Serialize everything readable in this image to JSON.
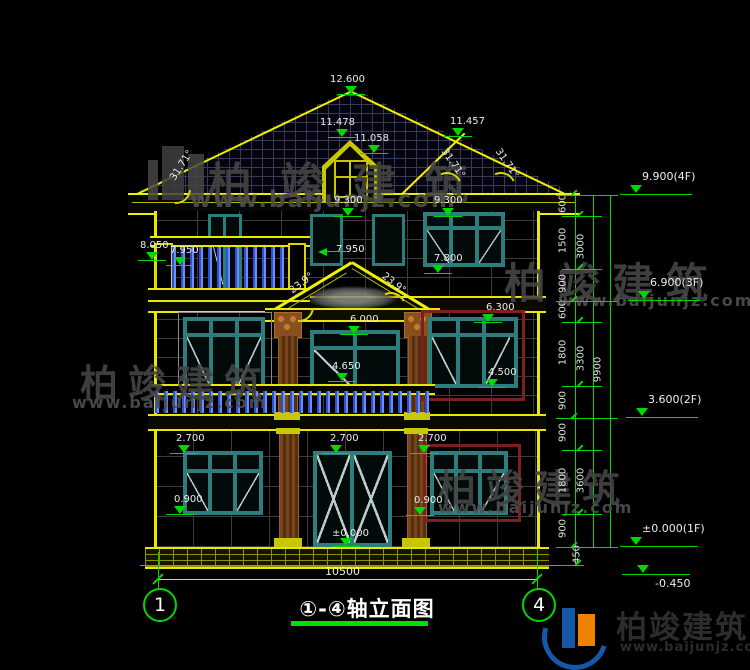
{
  "watermark": {
    "brand": "柏竣建筑",
    "url": "www.baijunjz.com"
  },
  "logo": {
    "brand": "柏竣建筑",
    "url": "www.baijunjz.com"
  },
  "title": {
    "text": "①-④轴立面图",
    "axis_left": "1",
    "axis_right": "4",
    "overall_dim": "10500"
  },
  "annotations": {
    "markers": [
      {
        "text": "12.600",
        "lx": 330,
        "ly": 74,
        "tx": 345,
        "ty": 86,
        "type": "down"
      },
      {
        "text": "11.478",
        "lx": 320,
        "ly": 117,
        "tx": 336,
        "ty": 129,
        "type": "down"
      },
      {
        "text": "11.058",
        "lx": 354,
        "ly": 133,
        "tx": 368,
        "ty": 145,
        "type": "down"
      },
      {
        "text": "11.457",
        "lx": 450,
        "ly": 116,
        "tx": 452,
        "ty": 128,
        "type": "down"
      },
      {
        "text": "9.300",
        "lx": 334,
        "ly": 195,
        "tx": 342,
        "ty": 208,
        "type": "down"
      },
      {
        "text": "9.300",
        "lx": 434,
        "ly": 195,
        "tx": 442,
        "ty": 208,
        "type": "down"
      },
      {
        "text": "8.050",
        "lx": 140,
        "ly": 240,
        "tx": 146,
        "ty": 252,
        "type": "down"
      },
      {
        "text": "7.950",
        "lx": 170,
        "ly": 245,
        "tx": 174,
        "ty": 257,
        "type": "down"
      },
      {
        "text": "7.950",
        "lx": 336,
        "ly": 244,
        "tx": 318,
        "ty": 248,
        "type": "left"
      },
      {
        "text": "7.800",
        "lx": 434,
        "ly": 253,
        "tx": 432,
        "ty": 265,
        "type": "down"
      },
      {
        "text": "6.300",
        "lx": 486,
        "ly": 302,
        "tx": 482,
        "ty": 314,
        "type": "down"
      },
      {
        "text": "6.000",
        "lx": 350,
        "ly": 314,
        "tx": 348,
        "ty": 326,
        "type": "down"
      },
      {
        "text": "4.650",
        "lx": 332,
        "ly": 361,
        "tx": 336,
        "ty": 373,
        "type": "down"
      },
      {
        "text": "4.500",
        "lx": 488,
        "ly": 367,
        "tx": 486,
        "ty": 379,
        "type": "down"
      },
      {
        "text": "2.700",
        "lx": 176,
        "ly": 433,
        "tx": 178,
        "ty": 445,
        "type": "down"
      },
      {
        "text": "2.700",
        "lx": 330,
        "ly": 433,
        "tx": 330,
        "ty": 445,
        "type": "down"
      },
      {
        "text": "2.700",
        "lx": 418,
        "ly": 433,
        "tx": 418,
        "ty": 445,
        "type": "down"
      },
      {
        "text": "0.900",
        "lx": 174,
        "ly": 494,
        "tx": 174,
        "ty": 506,
        "type": "down"
      },
      {
        "text": "0.900",
        "lx": 414,
        "ly": 495,
        "tx": 414,
        "ty": 507,
        "type": "down"
      },
      {
        "text": "±0.000",
        "lx": 332,
        "ly": 528,
        "tx": 340,
        "ty": 538,
        "type": "down"
      }
    ],
    "angles": [
      {
        "text": "31.71°",
        "x": 165,
        "y": 160,
        "rot": -57
      },
      {
        "text": "31.71°",
        "x": 436,
        "y": 158,
        "rot": 55
      },
      {
        "text": "31.71°",
        "x": 490,
        "y": 158,
        "rot": 55
      },
      {
        "text": "23.9°",
        "x": 288,
        "y": 278,
        "rot": -38
      },
      {
        "text": "23.9°",
        "x": 380,
        "y": 278,
        "rot": 38
      }
    ],
    "levels": [
      {
        "text": "9.900(4F)",
        "tx": 630,
        "lineX": 620,
        "lineY": 194,
        "lineW": 72,
        "flip": false
      },
      {
        "text": "6.900(3F)",
        "tx": 638,
        "lineX": 628,
        "lineY": 300,
        "lineW": 72,
        "flip": false
      },
      {
        "text": "3.600(2F)",
        "tx": 636,
        "lineX": 626,
        "lineY": 417,
        "lineW": 72,
        "flip": false
      },
      {
        "text": "±0.000(1F)",
        "tx": 630,
        "lineX": 620,
        "lineY": 546,
        "lineW": 78,
        "flip": false
      },
      {
        "text": "-0.450",
        "tx": 637,
        "lineX": 622,
        "lineY": 574,
        "lineW": 68,
        "flip": true
      }
    ],
    "chain_labels": [
      {
        "text": "600",
        "x": 563,
        "y": 205
      },
      {
        "text": "1500",
        "x": 563,
        "y": 242
      },
      {
        "text": "900",
        "x": 563,
        "y": 285
      },
      {
        "text": "600",
        "x": 563,
        "y": 311
      },
      {
        "text": "1800",
        "x": 563,
        "y": 354
      },
      {
        "text": "900",
        "x": 563,
        "y": 402
      },
      {
        "text": "900",
        "x": 563,
        "y": 434
      },
      {
        "text": "1800",
        "x": 563,
        "y": 482
      },
      {
        "text": "900",
        "x": 563,
        "y": 530
      },
      {
        "text": "450",
        "x": 577,
        "y": 556
      },
      {
        "text": "3000",
        "x": 581,
        "y": 248
      },
      {
        "text": "3300",
        "x": 581,
        "y": 360
      },
      {
        "text": "3600",
        "x": 581,
        "y": 482
      },
      {
        "text": "9900",
        "x": 598,
        "y": 371
      }
    ],
    "chain_ticks": [
      {
        "x": 556,
        "y": 195,
        "w": 62
      },
      {
        "x": 562,
        "y": 216,
        "w": 40
      },
      {
        "x": 562,
        "y": 269,
        "w": 40
      },
      {
        "x": 556,
        "y": 301,
        "w": 62
      },
      {
        "x": 562,
        "y": 322,
        "w": 40
      },
      {
        "x": 562,
        "y": 386,
        "w": 40
      },
      {
        "x": 556,
        "y": 418,
        "w": 62
      },
      {
        "x": 562,
        "y": 450,
        "w": 40
      },
      {
        "x": 562,
        "y": 514,
        "w": 40
      },
      {
        "x": 556,
        "y": 547,
        "w": 62
      },
      {
        "x": 560,
        "y": 565,
        "w": 24
      }
    ]
  }
}
